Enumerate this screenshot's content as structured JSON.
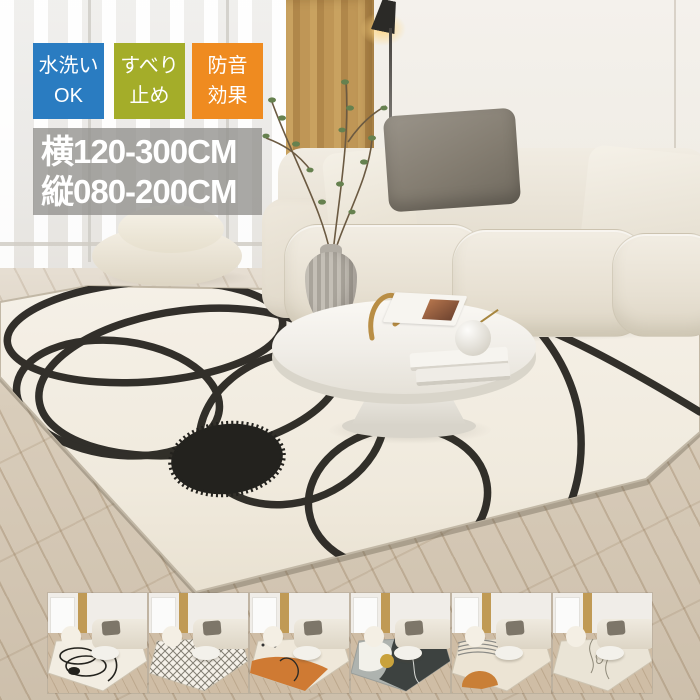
{
  "product_overlay": {
    "badges": [
      {
        "name": "washable-badge",
        "line1": "水洗い",
        "line2": "OK",
        "bg": "#2a7cc1"
      },
      {
        "name": "anti-slip-badge",
        "line1": "すべり",
        "line2": "止め",
        "bg": "#a4ad29"
      },
      {
        "name": "soundproof-badge",
        "line1": "防音",
        "line2": "効果",
        "bg": "#ef8b20"
      }
    ],
    "size_label": {
      "line1": "横120-300CM",
      "line2": "縦080-200CM",
      "bg": "rgba(148,146,142,0.8)",
      "text_color": "#ffffff"
    }
  },
  "thumbnails": [
    {
      "name": "black-line-rug",
      "pattern": "scribble",
      "accent": "#23221d"
    },
    {
      "name": "diamond-lattice-rug",
      "pattern": "lattice",
      "accent": "#6e6a5e"
    },
    {
      "name": "orange-wave-rug",
      "pattern": "wave",
      "accent": "#cf7a33"
    },
    {
      "name": "charcoal-abstract-rug",
      "pattern": "charcoal",
      "accent": "#3d4240"
    },
    {
      "name": "orange-arc-stripe-rug",
      "pattern": "arc",
      "accent": "#c97f36"
    },
    {
      "name": "thin-line-rug",
      "pattern": "thinline",
      "accent": "#8d8878"
    }
  ],
  "palette": {
    "rug": "#f2ede2",
    "rug_line": "#23211c",
    "floor_wood": "#d9cdbb",
    "sofa": "#ebe5d9",
    "curtain": "#bf9656",
    "wall": "#efebe3"
  }
}
